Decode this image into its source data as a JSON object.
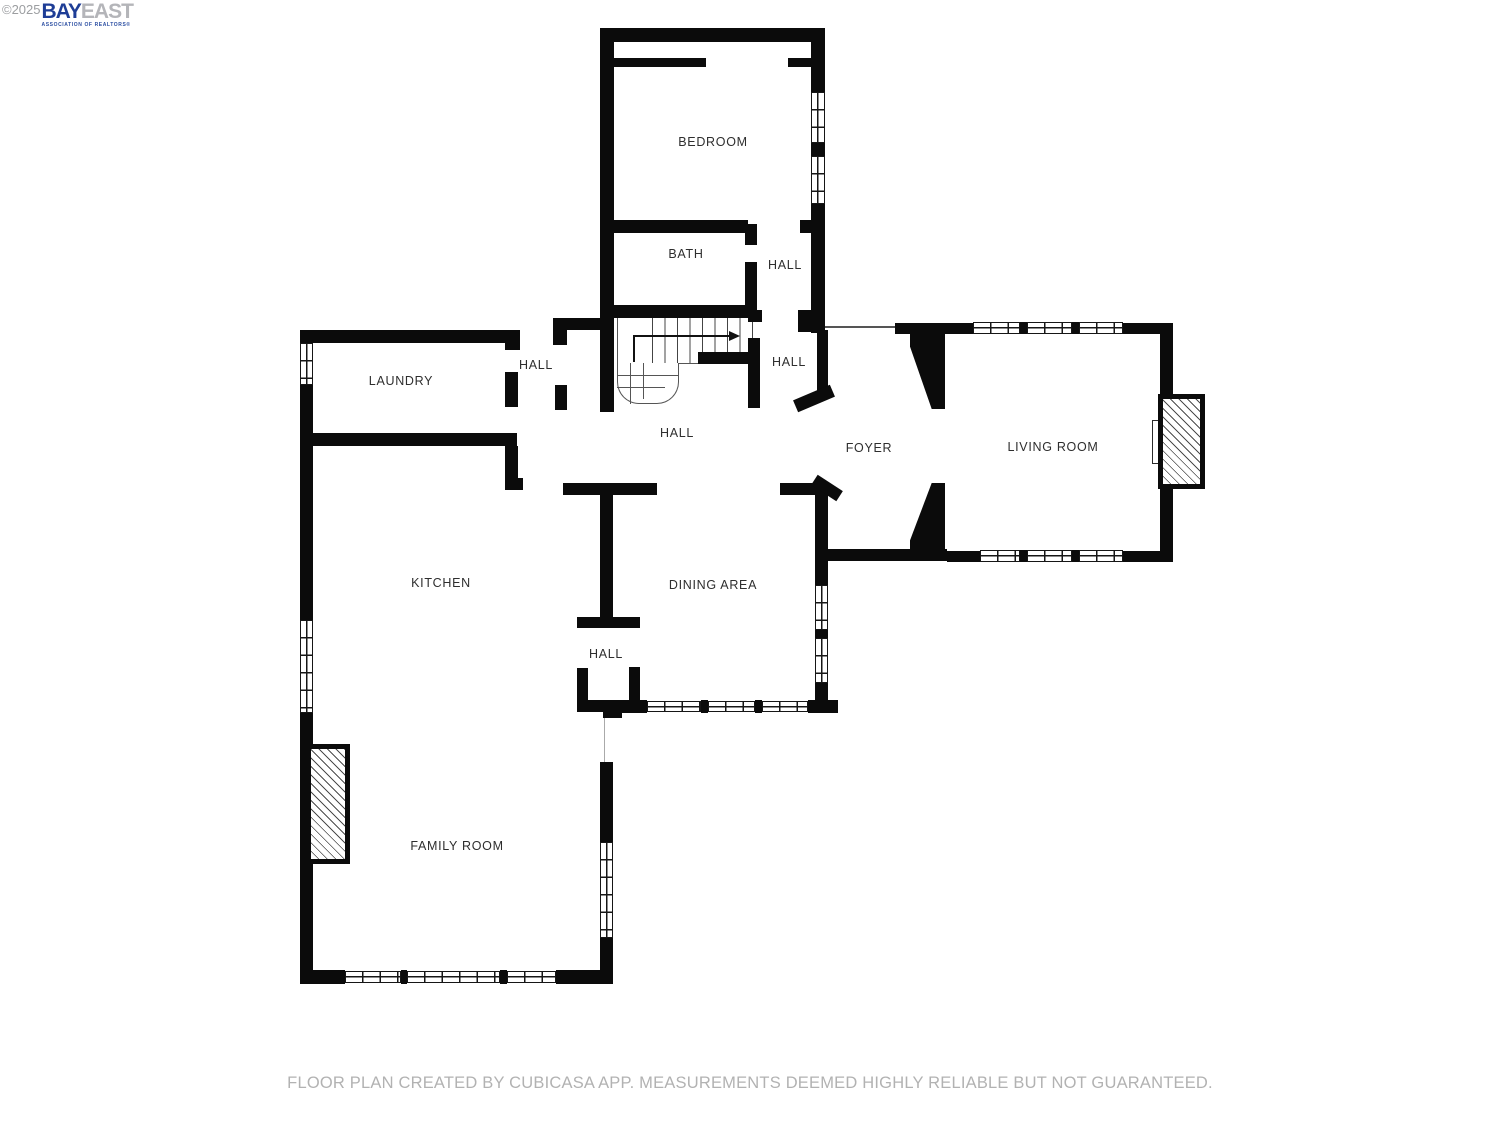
{
  "logo": {
    "copyright": "©2025",
    "brand_bay": "BAY",
    "brand_east": "EAST",
    "subtitle": "ASSOCIATION OF REALTORS®"
  },
  "rooms": {
    "bedroom": "BEDROOM",
    "bath": "BATH",
    "hall_bedroom": "HALL",
    "laundry": "LAUNDRY",
    "hall_laundry": "HALL",
    "hall_stairs": "HALL",
    "hall_main": "HALL",
    "foyer": "FOYER",
    "living_room": "LIVING ROOM",
    "kitchen": "KITCHEN",
    "dining_area": "DINING AREA",
    "hall_kitchen": "HALL",
    "family_room": "FAMILY ROOM"
  },
  "caption": "FLOOR PLAN CREATED BY CUBICASA APP. MEASUREMENTS DEEMED HIGHLY RELIABLE BUT NOT GUARANTEED.",
  "colors": {
    "wall": "#0b0b0b",
    "label": "#2e2e2e",
    "caption": "#b2b2b2",
    "brand_blue": "#1e3d96",
    "brand_gray": "#b4b5b9"
  }
}
